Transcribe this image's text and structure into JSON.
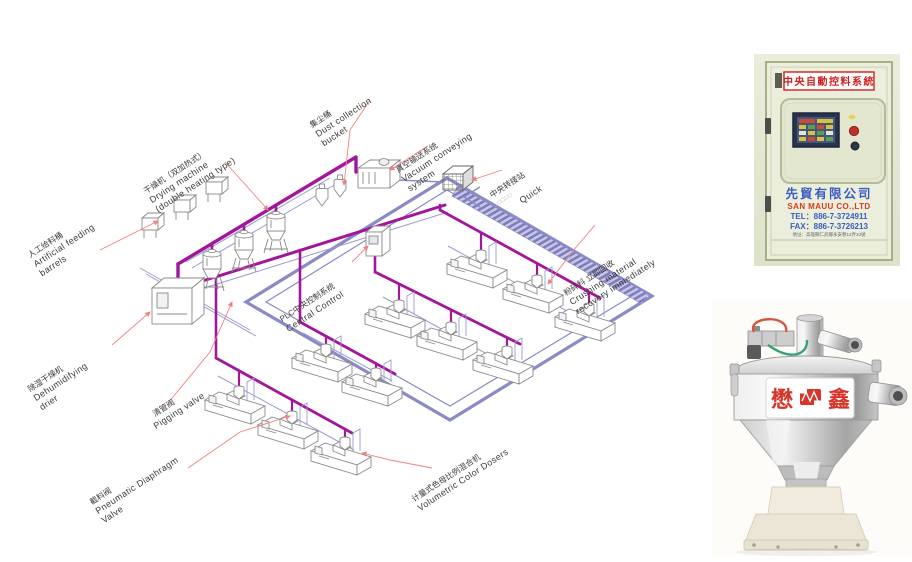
{
  "diagram": {
    "labels": {
      "artificial": {
        "zh": "人工给料桶",
        "en1": "Artificial feeding",
        "en2": "barrels"
      },
      "drying": {
        "zh": "干燥机（双加热式）",
        "en1": "Drying machine",
        "en2": "(double heating type)"
      },
      "dust": {
        "zh": "集尘桶",
        "en1": "Dust collection",
        "en2": "bucket"
      },
      "vacuum": {
        "zh": "真空输送系统",
        "en1": "Vacuum conveying",
        "en2": "system"
      },
      "transfer": {
        "zh": "中央转接站",
        "marks": "□□□□",
        "en1": "Quick"
      },
      "plc": {
        "zh": "PLC中央控制系统",
        "en1": "Central Control"
      },
      "dehumid": {
        "zh": "除湿干燥机",
        "en1": "Dehumidifying",
        "en2": "drier"
      },
      "pigging": {
        "zh": "清管阀",
        "en1": "Pigging valve"
      },
      "crushing": {
        "zh": "粉碎料 立即回收",
        "en1": "Crushing material",
        "en2": "recovery immediately"
      },
      "diaphragm": {
        "zh": "截料阀",
        "en1": "Pneumatic Diaphragm",
        "en2": "Valve"
      },
      "doser": {
        "zh": "计量式色母比例混合机",
        "en1": "Volumetric Color Dosers"
      }
    },
    "colors": {
      "pipe": "#A2169B",
      "loop": "#8A8AC6",
      "leader": "#F08080"
    }
  },
  "cabinet": {
    "header": "中央自動控料系統",
    "company_zh": "先貿有限公司",
    "company_en": "SAN MAUU CO.,LTD",
    "tel": "TEL：886-7-3724911",
    "fax": "FAX：886-7-3726213",
    "address": "地址：高雄縣仁武鄉永安巷12弄33號"
  },
  "hopper": {
    "brand_left": "懋",
    "brand_right": "鑫"
  }
}
